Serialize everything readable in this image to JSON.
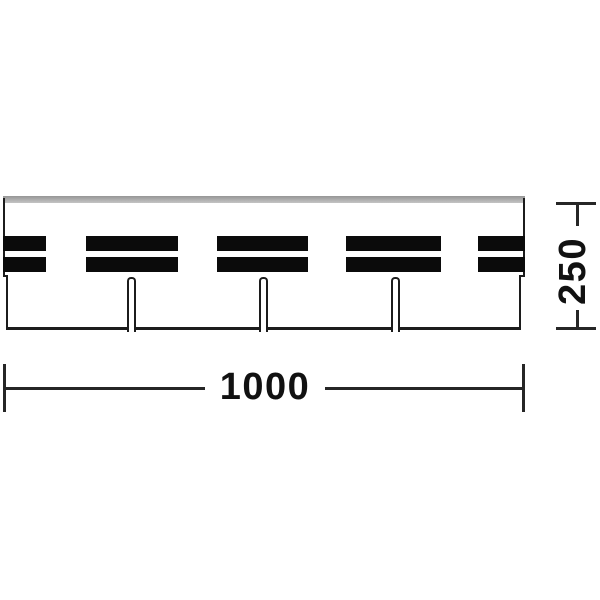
{
  "diagram": {
    "type": "technical-drawing",
    "subject": "three-tab shingle strip, front elevation",
    "shingle": {
      "tab_count": 4,
      "keyway_slot_count": 3,
      "sealant_bar_rows": 2,
      "sealant_bar_groups": 5
    },
    "dimensions": {
      "width": {
        "label": "1000"
      },
      "height": {
        "label": "250"
      }
    },
    "colors": {
      "outline": "#1c1c1c",
      "sealant_bar_fill": "#0b0b0b",
      "top_edge_gray": "#ababab",
      "dimension_line": "#262626",
      "label_text": "#111111",
      "background": "#ffffff"
    }
  }
}
